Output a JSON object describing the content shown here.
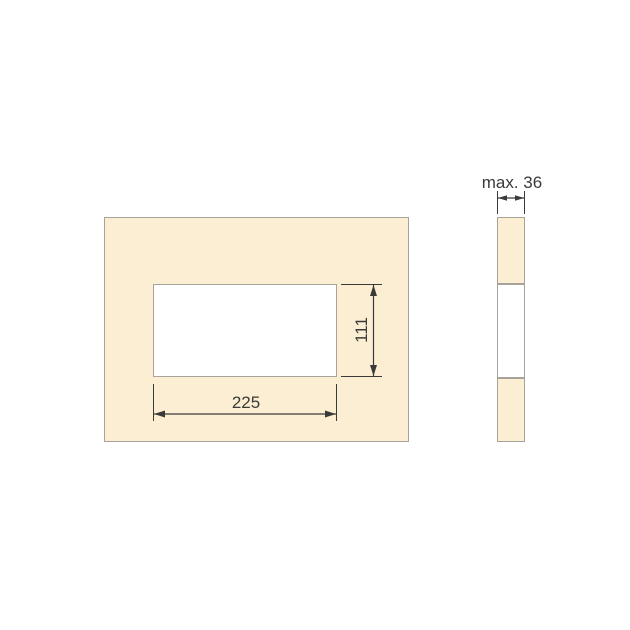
{
  "drawing": {
    "front_view": {
      "cutout_width_label": "225",
      "cutout_height_label": "111"
    },
    "side_view": {
      "thickness_label": "max. 36"
    }
  },
  "colors": {
    "background": "#ffffff",
    "panel_fill": "#fbeed2",
    "panel_border": "#a7a39b",
    "dimension_ink": "#3a3a38"
  }
}
